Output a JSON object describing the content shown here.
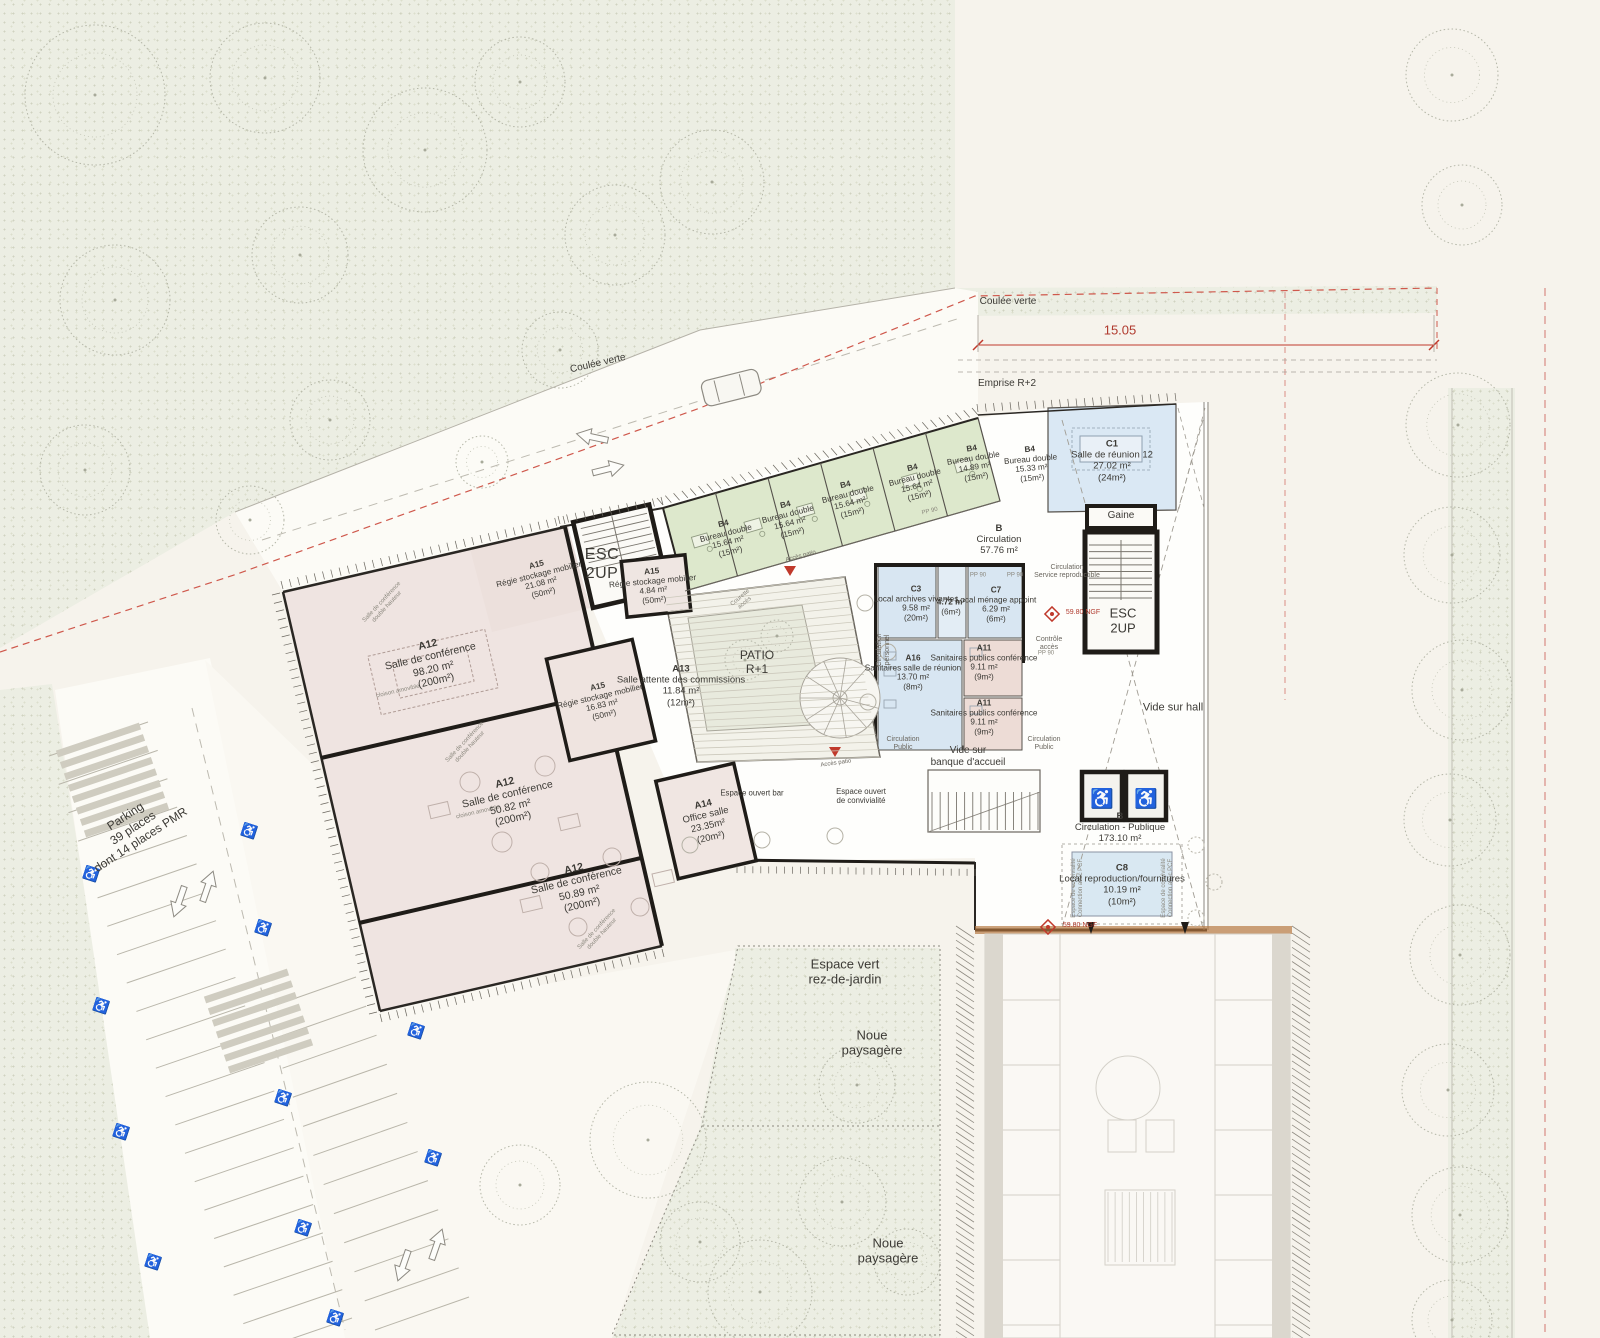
{
  "labels": {
    "coulee_verte": "Coulée verte",
    "dimension_15_05": "15.05",
    "emprise": "Emprise R+2",
    "parking": "Parking\n39 places\ndont 14 places PMR",
    "espace_vert": "Espace vert\nrez-de-jardin",
    "noue": "Noue\npaysagère",
    "esc": "ESC\n2UP",
    "gaine": "Gaine",
    "vide_hall": "Vide sur hall",
    "vide_banque": "Vide sur\nbanque d'accueil",
    "circ_public": "Circulation\nPublic",
    "circ_service": "Circulation\nService reproductible",
    "circ_personnel": "Circulation\npersonnel",
    "controle": "Contrôle\naccès",
    "pp90": "PP 90",
    "ngf": "59.80 NGF",
    "acces_patio": "Accès patio",
    "conviv": "Espace de convivialité\nConnection avec PCF",
    "espace_bar": "Espace ouvert bar",
    "espace_conviv": "Espace ouvert\nde convivialité",
    "conf_double_hauteur": "Salle de conférence\ndouble hauteur",
    "cloison": "cloison amovible",
    "courette": "Courette\naccès",
    "patio": "PATIO\nR+1"
  },
  "icons": {
    "wheelchair": "♿"
  },
  "colors": {
    "office_green": "#dde8cc",
    "meeting_blue": "#d8e6f2",
    "conference_pink": "#efe4e0",
    "boundary_red": "#cf584c"
  },
  "rooms": [
    {
      "code": "B4",
      "name": "Bureau double",
      "area": "15.64 m²",
      "cap": "(15m²)"
    },
    {
      "code": "B4",
      "name": "Bureau double",
      "area": "15.64 m²",
      "cap": "(15m²)"
    },
    {
      "code": "B4",
      "name": "Bureau double",
      "area": "15.64 m²",
      "cap": "(15m²)"
    },
    {
      "code": "B4",
      "name": "Bureau double",
      "area": "15.64 m²",
      "cap": "(15m²)"
    },
    {
      "code": "B4",
      "name": "Bureau double",
      "area": "14.89 m²",
      "cap": "(15m²)"
    },
    {
      "code": "B4",
      "name": "Bureau double",
      "area": "15.33 m²",
      "cap": "(15m²)"
    },
    {
      "code": "C1",
      "name": "Salle de réunion 12",
      "area": "27.02 m²",
      "cap": "(24m²)"
    },
    {
      "code": "B",
      "name": "Circulation",
      "area": "57.76 m²",
      "cap": ""
    },
    {
      "code": "A15",
      "name": "Régie stockage mobilier",
      "area": "21.08 m²",
      "cap": "(50m²)"
    },
    {
      "code": "A15",
      "name": "Régie stockage mobilier",
      "area": "4.84 m²",
      "cap": "(50m²)"
    },
    {
      "code": "A12",
      "name": "Salle de conférence",
      "area": "98.20 m²",
      "cap": "(200m²)"
    },
    {
      "code": "A15",
      "name": "Régie stockage mobilier",
      "area": "16.83 m²",
      "cap": "(50m²)"
    },
    {
      "code": "A13",
      "name": "Salle attente des commissions",
      "area": "11.84 m²",
      "cap": "(12m²)"
    },
    {
      "code": "C3",
      "name": "Local archives vivantes",
      "area": "9.58 m²",
      "cap": "(20m²)"
    },
    {
      "code": "",
      "name": "",
      "area": "4.72 m²",
      "cap": "(6m²)"
    },
    {
      "code": "C7",
      "name": "Local ménage appoint",
      "area": "6.29 m²",
      "cap": "(6m²)"
    },
    {
      "code": "A16",
      "name": "Sanitaires salle de réunion",
      "area": "13.70 m²",
      "cap": "(8m²)"
    },
    {
      "code": "A11",
      "name": "Sanitaires publics conférence",
      "area": "9.11 m²",
      "cap": "(9m²)"
    },
    {
      "code": "A11",
      "name": "Sanitaires publics conférence",
      "area": "9.11 m²",
      "cap": "(9m²)"
    },
    {
      "code": "A12",
      "name": "Salle de conférence",
      "area": "50.82 m²",
      "cap": "(200m²)"
    },
    {
      "code": "A14",
      "name": "Office salle",
      "area": "23.35m²",
      "cap": "(20m²)"
    },
    {
      "code": "A12",
      "name": "Salle de conférence",
      "area": "50.89 m²",
      "cap": "(200m²)"
    },
    {
      "code": "B",
      "name": "Circulation - Publique",
      "area": "173.10 m²",
      "cap": ""
    },
    {
      "code": "C8",
      "name": "Local reproduction/fournitures",
      "area": "10.19 m²",
      "cap": "(10m²)"
    }
  ]
}
